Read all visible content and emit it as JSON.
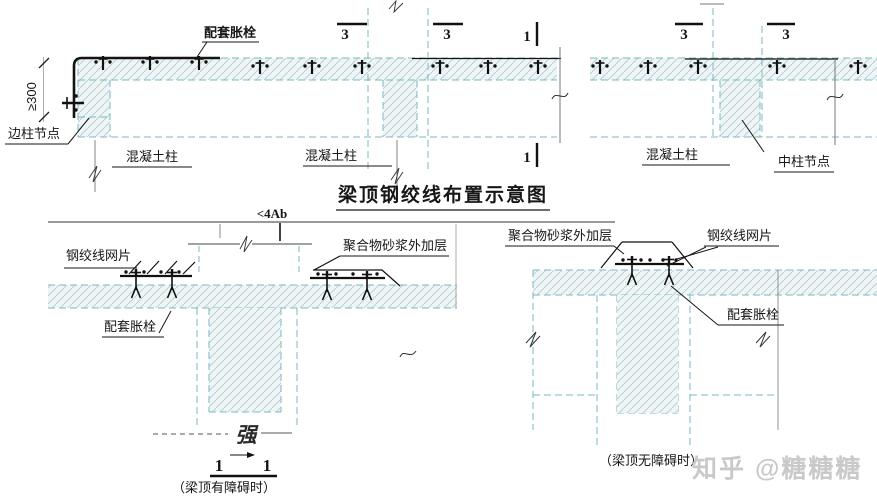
{
  "title": "梁顶钢绞线布置示意图",
  "watermark": "知乎 @糖糖糖",
  "top": {
    "bolt_label": "配套胀栓",
    "edge_node_label": "边柱节点",
    "min_dim": "≥300",
    "col_label_1": "混凝土柱",
    "col_label_2": "混凝土柱",
    "col_label_3": "混凝土柱",
    "center_node_label": "中柱节点",
    "section3_1": "3",
    "section3_2": "3",
    "section3_3": "3",
    "section3_4": "3",
    "section1_top": "1",
    "section1_bottom": "1"
  },
  "obstructed": {
    "spacing_dim": "<4Ab",
    "mesh_label": "钢绞线网片",
    "mortar_label": "聚合物砂浆外加层",
    "bolt_label": "配套胀栓",
    "stamp": "强",
    "section_num_left": "1",
    "section_num_right": "1",
    "caption": "（梁顶有障碍时）"
  },
  "unobstructed": {
    "mortar_label": "聚合物砂浆外加层",
    "mesh_label": "钢绞线网片",
    "bolt_label": "配套胀栓",
    "caption": "（梁顶无障碍时）"
  },
  "colors": {
    "line": "#1a1a1a",
    "hidden_dash": "#79b8c5",
    "hatch": "#b0cdd3",
    "watermark": "#c9c9c9"
  }
}
